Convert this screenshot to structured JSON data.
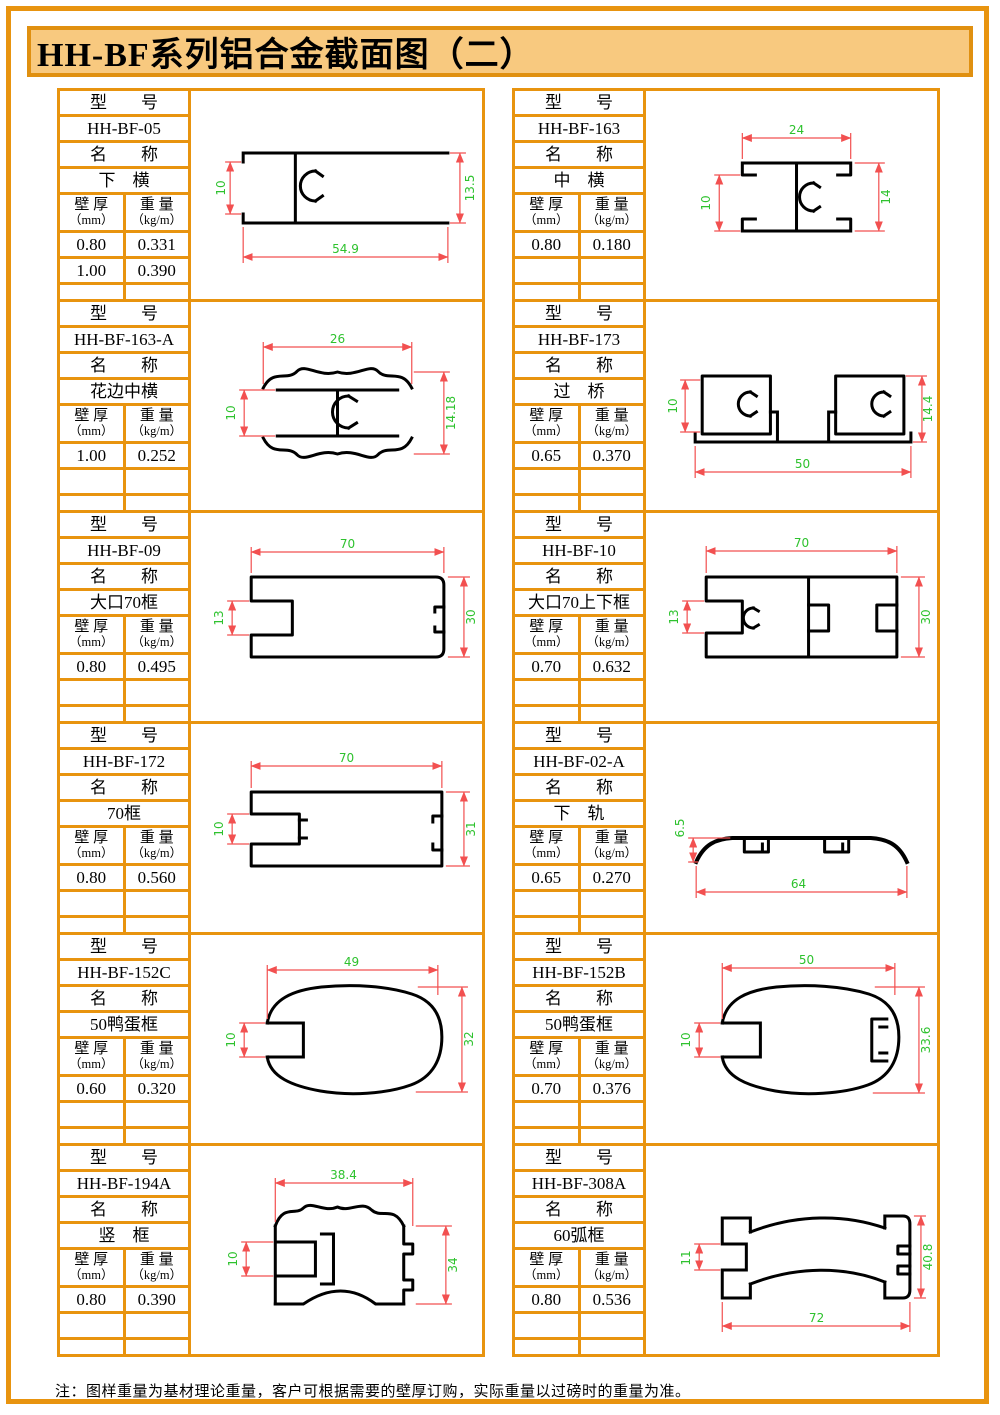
{
  "title": "HH-BF系列铝合金截面图（二）",
  "note": "注：图样重量为基材理论重量，客户可根据需要的壁厚订购，实际重量以过磅时的重量为准。",
  "labels": {
    "model": "型　　号",
    "name": "名　　称",
    "thickness_line1": "壁 厚",
    "thickness_line2": "（mm）",
    "weight_line1": "重 量",
    "weight_line2": "（kg/m）"
  },
  "colors": {
    "frame_orange": "#e8940f",
    "title_background": "#f8c97f",
    "dimension_line": "#f25050",
    "dimension_text": "#2ec22e",
    "profile_line": "#000000"
  },
  "cells": [
    {
      "model": "HH-BF-05",
      "name": "下　横",
      "rows": [
        [
          "0.80",
          "0.331"
        ],
        [
          "1.00",
          "0.390"
        ]
      ],
      "dims": {
        "left": "10",
        "right": "13.5",
        "bottom": "54.9"
      }
    },
    {
      "model": "HH-BF-163",
      "name": "中　横",
      "rows": [
        [
          "0.80",
          "0.180"
        ]
      ],
      "dims": {
        "top": "24",
        "left": "10",
        "right": "14"
      }
    },
    {
      "model": "HH-BF-163-A",
      "name": "花边中横",
      "rows": [
        [
          "1.00",
          "0.252"
        ]
      ],
      "dims": {
        "top": "26",
        "left": "10",
        "right": "14.18"
      }
    },
    {
      "model": "HH-BF-173",
      "name": "过　桥",
      "rows": [
        [
          "0.65",
          "0.370"
        ]
      ],
      "dims": {
        "left": "10",
        "right": "14.4",
        "bottom": "50"
      }
    },
    {
      "model": "HH-BF-09",
      "name": "大口70框",
      "rows": [
        [
          "0.80",
          "0.495"
        ]
      ],
      "dims": {
        "top": "70",
        "left": "13",
        "right": "30"
      }
    },
    {
      "model": "HH-BF-10",
      "name": "大口70上下框",
      "rows": [
        [
          "0.70",
          "0.632"
        ]
      ],
      "dims": {
        "top": "70",
        "left": "13",
        "right": "30"
      }
    },
    {
      "model": "HH-BF-172",
      "name": "70框",
      "rows": [
        [
          "0.80",
          "0.560"
        ]
      ],
      "dims": {
        "top": "70",
        "left": "10",
        "right": "31"
      }
    },
    {
      "model": "HH-BF-02-A",
      "name": "下　轨",
      "rows": [
        [
          "0.65",
          "0.270"
        ]
      ],
      "dims": {
        "left": "6.5",
        "bottom": "64"
      }
    },
    {
      "model": "HH-BF-152C",
      "name": "50鸭蛋框",
      "rows": [
        [
          "0.60",
          "0.320"
        ]
      ],
      "dims": {
        "top": "49",
        "left": "10",
        "right": "32"
      }
    },
    {
      "model": "HH-BF-152B",
      "name": "50鸭蛋框",
      "rows": [
        [
          "0.70",
          "0.376"
        ]
      ],
      "dims": {
        "top": "50",
        "left": "10",
        "right": "33.6"
      }
    },
    {
      "model": "HH-BF-194A",
      "name": "竖　框",
      "rows": [
        [
          "0.80",
          "0.390"
        ]
      ],
      "dims": {
        "top": "38.4",
        "left": "10",
        "right": "34"
      }
    },
    {
      "model": "HH-BF-308A",
      "name": "60弧框",
      "rows": [
        [
          "0.80",
          "0.536"
        ]
      ],
      "dims": {
        "left": "11",
        "right": "40.8",
        "bottom": "72"
      }
    }
  ]
}
